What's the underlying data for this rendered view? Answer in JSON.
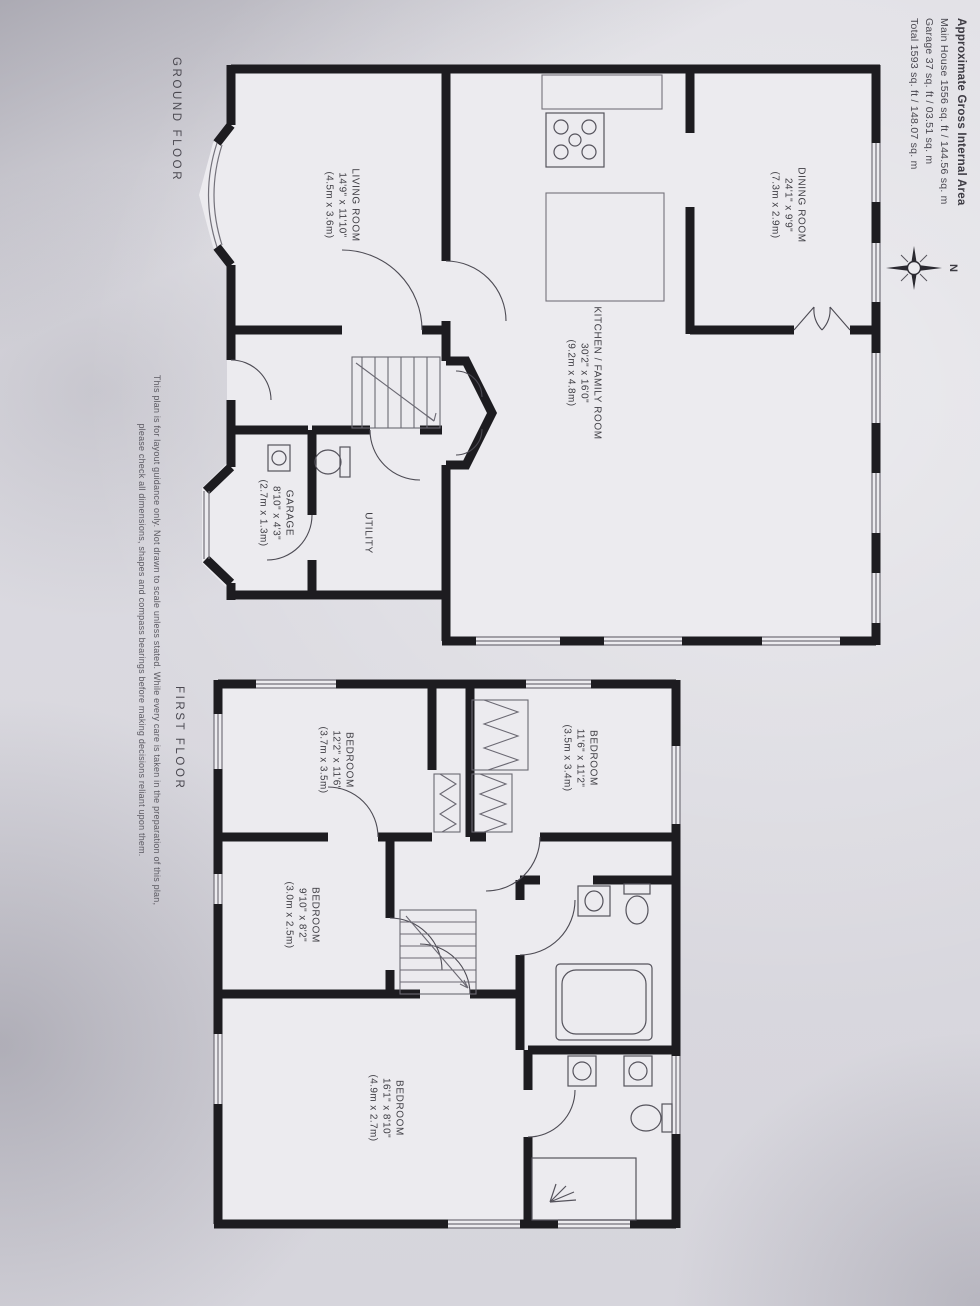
{
  "header": {
    "title": "Approximate Gross Internal Area",
    "main_house": "Main House 1556 sq. ft / 144.56 sq. m",
    "garage": "Garage 37 sq. ft / 03.51 sq. m",
    "total": "Total 1593 sq. ft / 148.07 sq. m"
  },
  "compass": {
    "north_label": "N"
  },
  "ground_floor": {
    "title": "GROUND FLOOR",
    "rooms": {
      "dining": {
        "name": "DINING ROOM",
        "imperial": "24'1\" x 9'9\"",
        "metric": "(7.3m x 2.9m)"
      },
      "kitchen": {
        "name": "KITCHEN / FAMILY ROOM",
        "imperial": "30'2\" x 16'0\"",
        "metric": "(9.2m x 4.8m)"
      },
      "living": {
        "name": "LIVING ROOM",
        "imperial": "14'9\" x 11'10\"",
        "metric": "(4.5m x 3.6m)"
      },
      "utility": {
        "name": "UTILITY"
      },
      "garage": {
        "name": "GARAGE",
        "imperial": "8'10\" x 4'3\"",
        "metric": "(2.7m x 1.3m)"
      }
    }
  },
  "first_floor": {
    "title": "FIRST FLOOR",
    "rooms": {
      "bedroom1": {
        "name": "BEDROOM",
        "imperial": "11'6\" x 11'2\"",
        "metric": "(3.5m x 3.4m)"
      },
      "bedroom2": {
        "name": "BEDROOM",
        "imperial": "12'2\" x 11'6\"",
        "metric": "(3.7m x 3.5m)"
      },
      "bedroom3": {
        "name": "BEDROOM",
        "imperial": "9'10\" x 8'2\"",
        "metric": "(3.0m x 2.5m)"
      },
      "bedroom4": {
        "name": "BEDROOM",
        "imperial": "16'1\" x 8'10\"",
        "metric": "(4.9m x 2.7m)"
      }
    }
  },
  "disclaimer": {
    "line1": "This plan is for layout guidance only.  Not drawn to scale unless stated.  While every care is taken in the preparation of this plan,",
    "line2": "please check all dimensions, shapes and compass bearings before making decisions reliant upon them."
  },
  "colors": {
    "wall": "#1d1c20",
    "paper": "#ebeaee",
    "ink": "#3e3d43"
  }
}
